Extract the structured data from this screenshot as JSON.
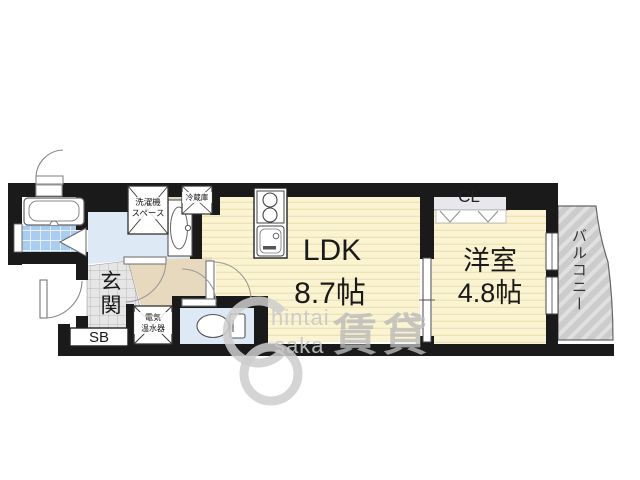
{
  "rooms": {
    "ldk": {
      "label": "LDK",
      "size": "8.7帖"
    },
    "western_room": {
      "label": "洋室",
      "size": "4.8帖"
    },
    "closet": {
      "label": "CL"
    },
    "balcony": {
      "label": "バルコニー"
    },
    "entrance": {
      "label": "玄関"
    },
    "shoe_box": {
      "label": "SB"
    }
  },
  "fixtures": {
    "washing_machine_space": {
      "line1": "洗濯機",
      "line2": "スペース"
    },
    "refrigerator": {
      "label": "冷蔵庫"
    },
    "water_heater": {
      "line1": "電気",
      "line2": "温水器"
    }
  },
  "watermark": {
    "text_top": "hintai",
    "text_bottom": "saka",
    "kanji": "賃貸"
  },
  "colors": {
    "wall": "#1a1a1a",
    "wood_floor": "#FBF4D2",
    "wood_floor_stripe": "#EEE3B4",
    "bath_tile": "#A9CDF0",
    "wet_room_floor": "#DEE9F6",
    "hallway_floor": "#E7D9BE",
    "entrance_tile": "#E6E6E6",
    "closet_fill": "#E7E7EC",
    "balcony_fill": "#CCCCCC",
    "balcony_stripe": "#E0E0E0",
    "fixture_outline": "#555555"
  }
}
